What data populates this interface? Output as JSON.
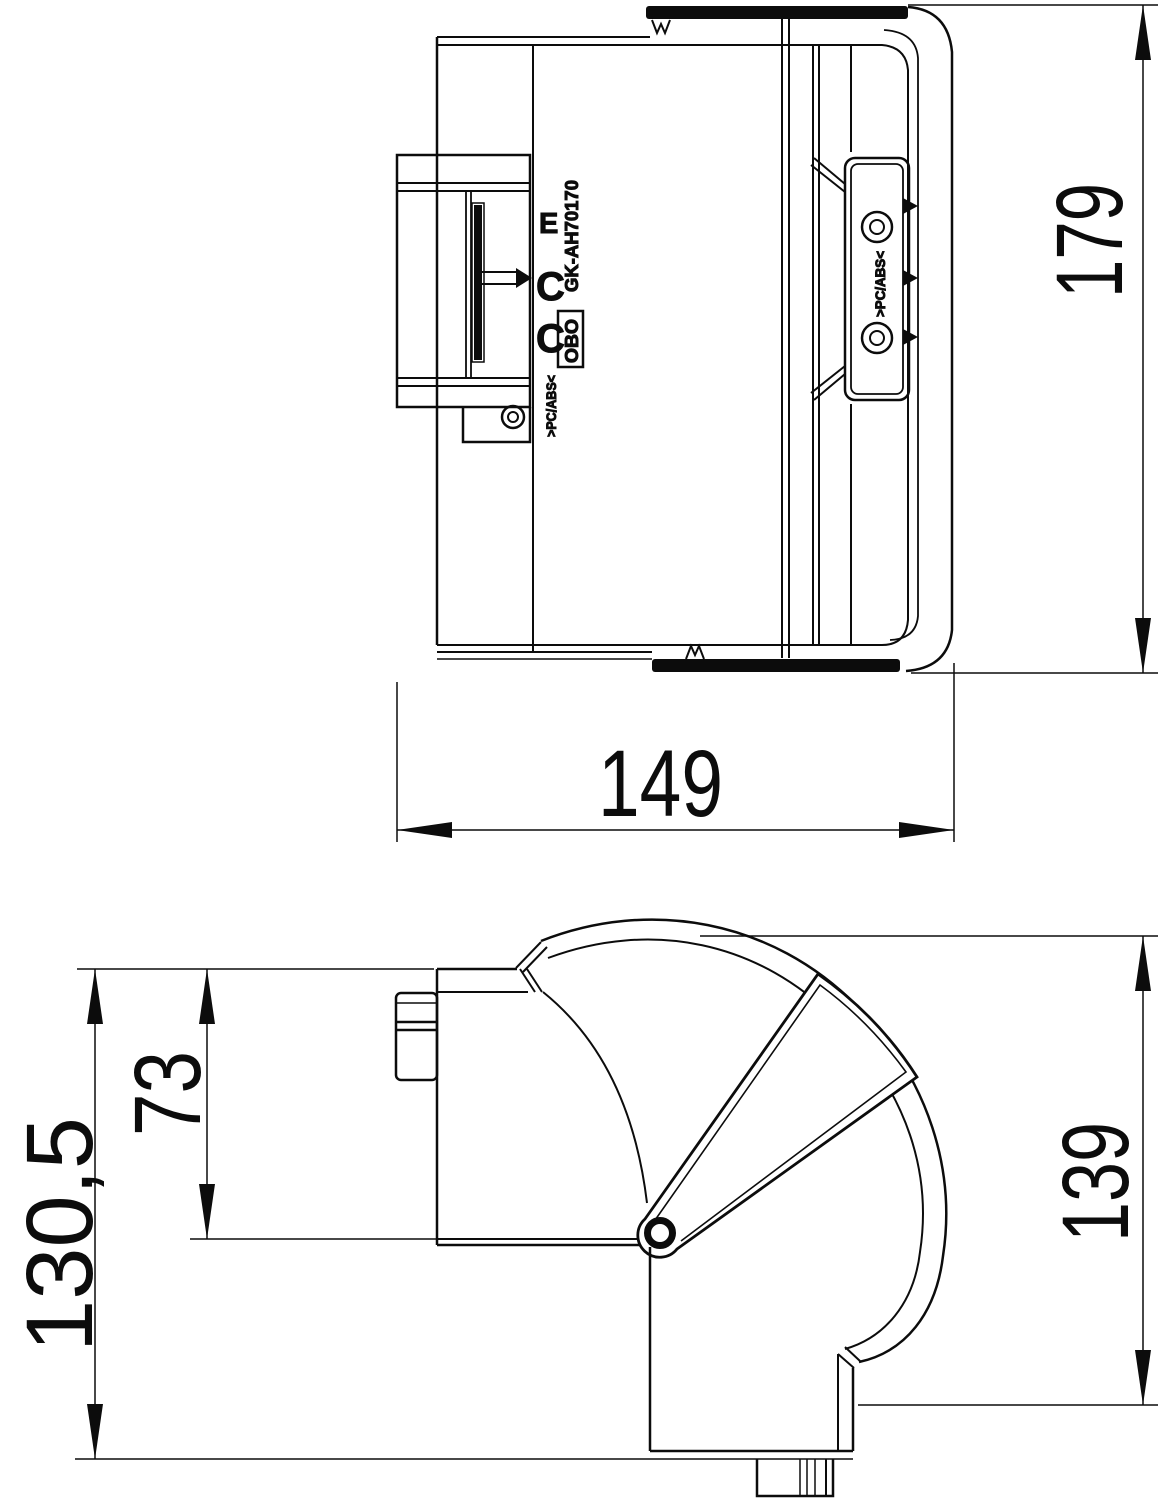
{
  "drawing": {
    "product_code": "GK-AH70170",
    "brand_logo": "OBO",
    "material_marking_left": ">PC/ABS<",
    "material_marking_plate": ">PC/ABS<",
    "clip_marks": [
      "E",
      "C",
      "C"
    ],
    "dims": {
      "top_height": "179",
      "top_width": "149",
      "side_overall_height": "130,5",
      "side_upper_height": "73",
      "side_outlet_height": "139"
    },
    "line_color": "#0c0c0c",
    "background_color": "#ffffff"
  }
}
